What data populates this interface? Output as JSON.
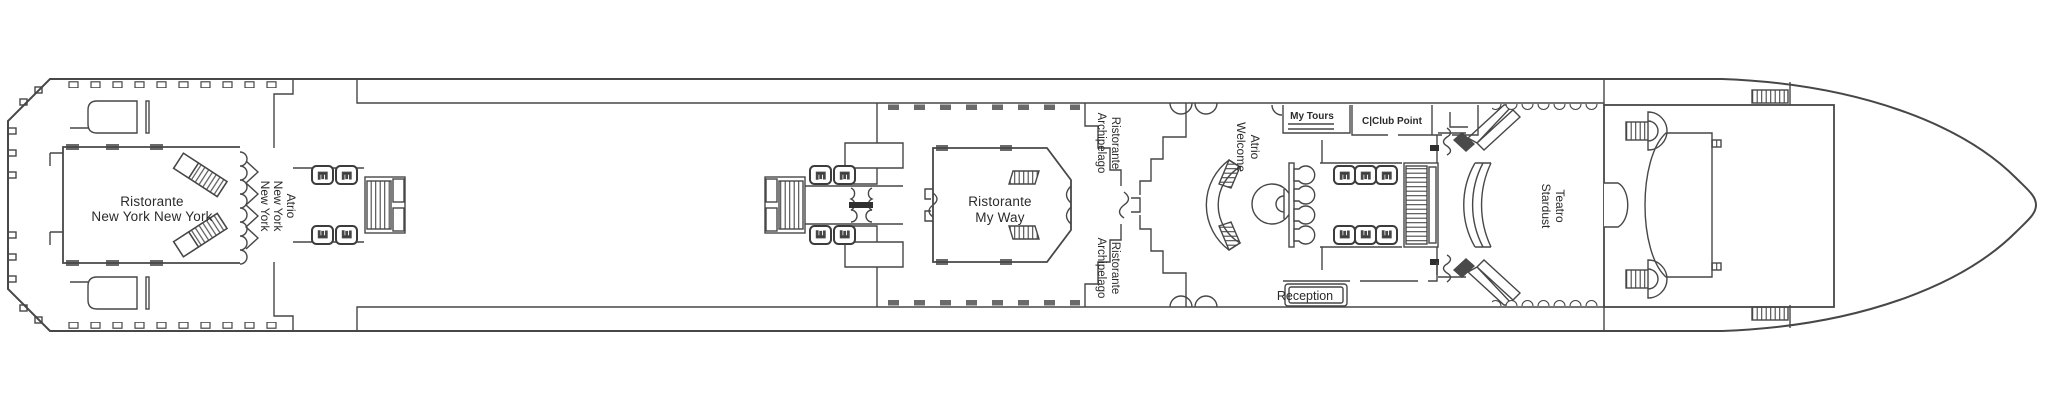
{
  "diagram_type": "cruise-ship-deck-plan",
  "colors": {
    "line": "#474747",
    "dark_fill": "#2f2f2f",
    "text": "#2b2b2b",
    "background": "#ffffff"
  },
  "icons": {
    "elevator_glyph": "E"
  },
  "rooms": {
    "ristorante_nyny": {
      "line1": "Ristorante",
      "line2": "New York New York"
    },
    "atrio_nyny": {
      "line1": "Atrio",
      "line2": "New York",
      "line3": "New York"
    },
    "ristorante_my_way": {
      "line1": "Ristorante",
      "line2": "My Way"
    },
    "ristorante_archipelago": {
      "line1": "Ristorante",
      "line2": "Archipelago"
    },
    "atrio_welcome": {
      "line1": "Atrio",
      "line2": "Welcome"
    },
    "my_tours": {
      "label": "My Tours"
    },
    "cclub_point": {
      "label": "C|Club Point"
    },
    "reception": {
      "label": "Reception"
    },
    "teatro_stardust": {
      "line1": "Teatro",
      "line2": "Stardust"
    }
  }
}
